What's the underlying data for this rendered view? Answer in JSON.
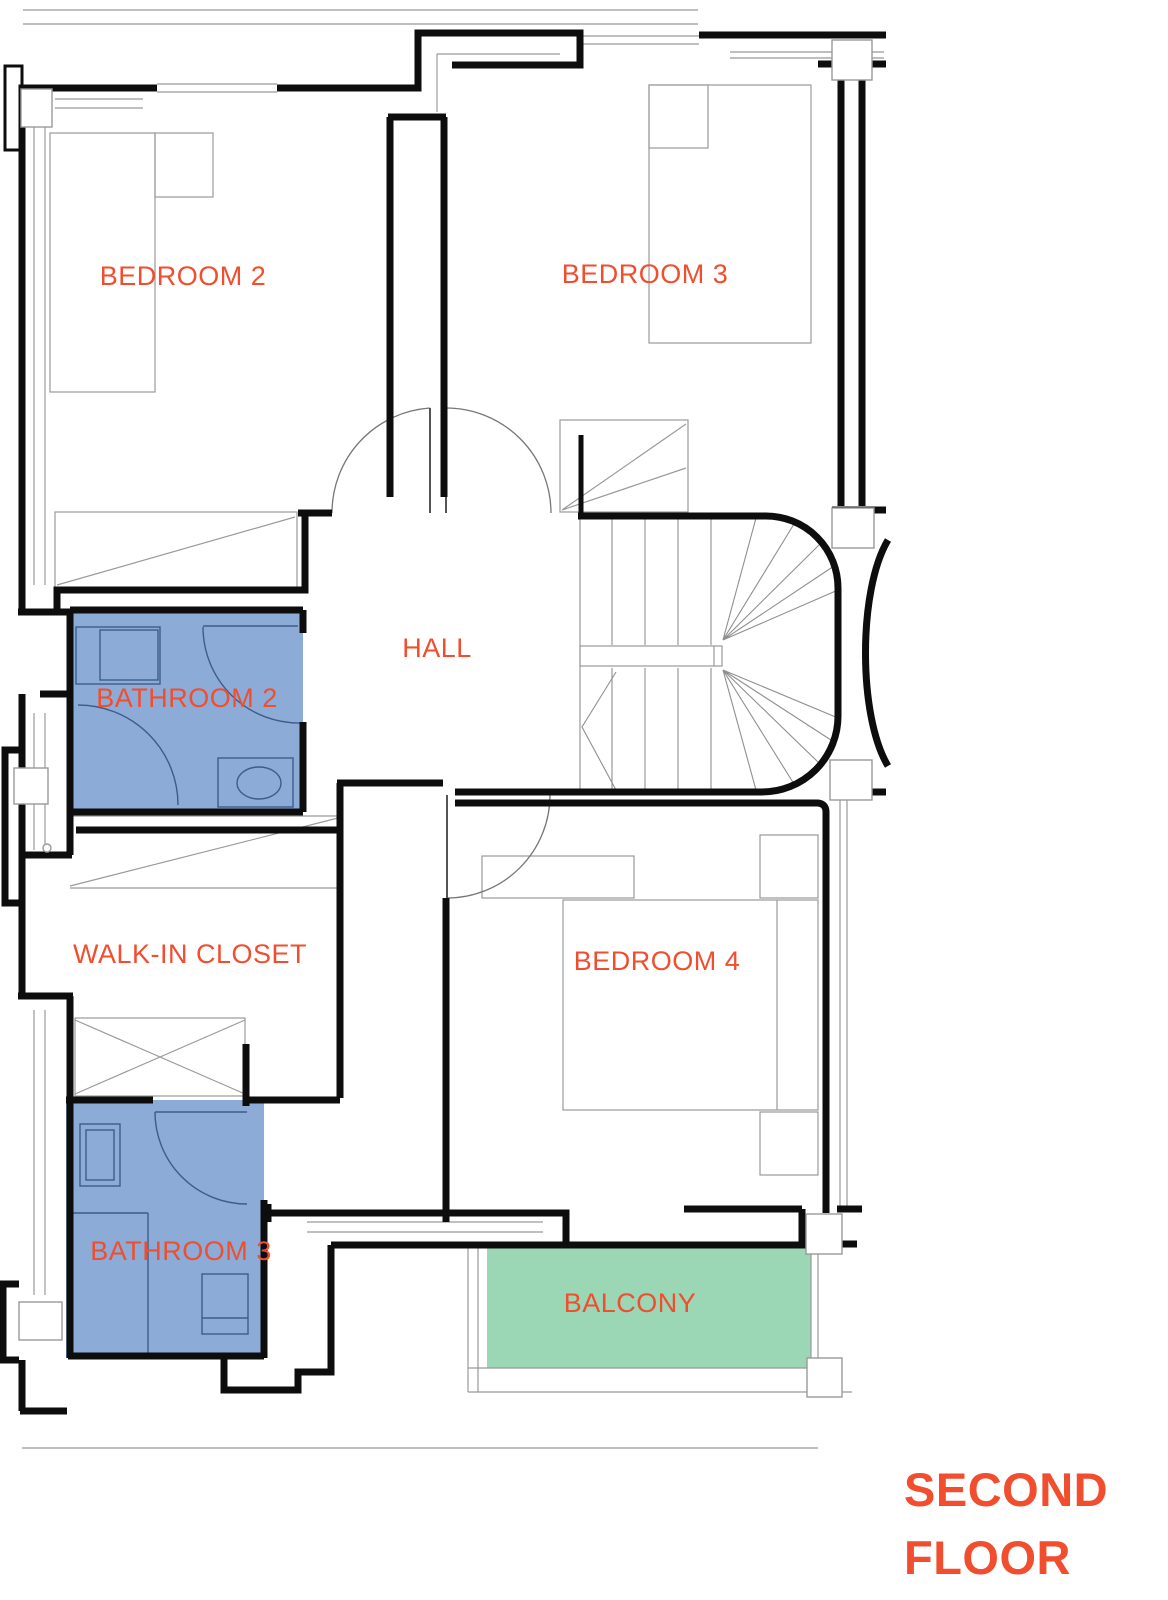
{
  "floor_plan": {
    "title": {
      "line1": "SECOND",
      "line2": "FLOOR"
    },
    "rooms": [
      {
        "id": "bedroom-2",
        "label": "BEDROOM 2"
      },
      {
        "id": "bedroom-3",
        "label": "BEDROOM 3"
      },
      {
        "id": "hall",
        "label": "HALL"
      },
      {
        "id": "bathroom-2",
        "label": "BATHROOM 2"
      },
      {
        "id": "walk-in-closet",
        "label": "WALK-IN CLOSET"
      },
      {
        "id": "bedroom-4",
        "label": "BEDROOM 4"
      },
      {
        "id": "bathroom-3",
        "label": "BATHROOM 3"
      },
      {
        "id": "balcony",
        "label": "BALCONY"
      }
    ],
    "colors": {
      "label_text": "#f04e2e",
      "bathroom_fill": "#8dabd7",
      "balcony_fill": "#9bd6b5",
      "wall": "#0d0d0d",
      "detail_line": "#999999",
      "fixture_line": "#3d5c8c",
      "background": "#ffffff"
    }
  }
}
